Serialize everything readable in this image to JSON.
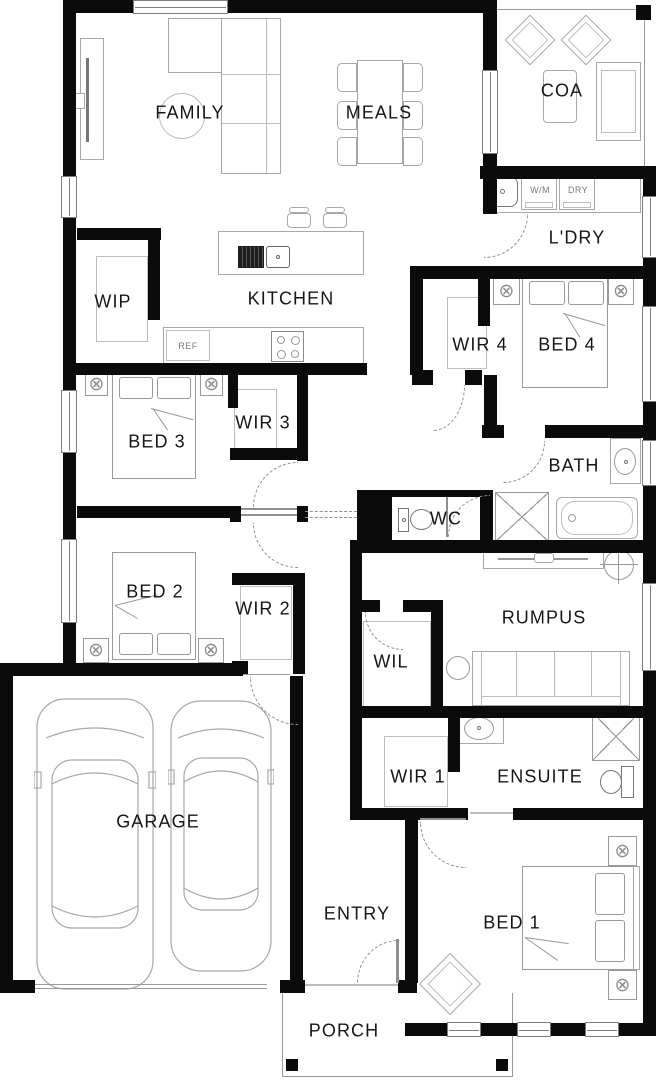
{
  "rooms": {
    "family": "FAMILY",
    "meals": "MEALS",
    "coa": "COA",
    "laundry": "L'DRY",
    "wip": "WIP",
    "kitchen": "KITCHEN",
    "wir4": "WIR 4",
    "bed4": "BED 4",
    "bed3": "BED 3",
    "wir3": "WIR 3",
    "bath": "BATH",
    "wc": "WC",
    "bed2": "BED 2",
    "wir2": "WIR 2",
    "rumpus": "RUMPUS",
    "wil": "WIL",
    "wir1": "WIR 1",
    "ensuite": "ENSUITE",
    "garage": "GARAGE",
    "entry": "ENTRY",
    "bed1": "BED 1",
    "porch": "PORCH"
  },
  "appliances": {
    "washer": "W/M",
    "dryer": "DRY",
    "fridge": "REF"
  },
  "colors": {
    "wall": "#0b0b0b",
    "furniture_line": "#9a9a9a",
    "label_text": "#161616"
  }
}
